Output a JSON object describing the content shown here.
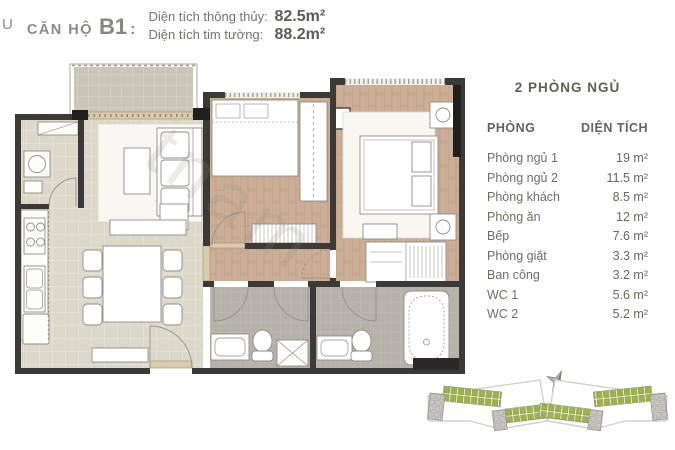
{
  "header": {
    "edge_text": "U",
    "unit_label": "CĂN HỘ",
    "unit_code": "B1",
    "separator": ":",
    "metrics": [
      {
        "label": "Diện tích thông thủy:",
        "value": "82.5m²"
      },
      {
        "label": "Diện tích tim tường:",
        "value": "88.2m²"
      }
    ]
  },
  "area_table": {
    "title": "2 PHÒNG NGỦ",
    "columns": {
      "room": "PHÒNG",
      "area": "DIỆN TÍCH"
    },
    "rows": [
      {
        "room": "Phòng ngủ 1",
        "area": "19 m²"
      },
      {
        "room": "Phòng ngủ 2",
        "area": "11.5 m²"
      },
      {
        "room": "Phòng khách",
        "area": "8.5 m²"
      },
      {
        "room": "Phòng ăn",
        "area": "12 m²"
      },
      {
        "room": "Bếp",
        "area": "7.6 m²"
      },
      {
        "room": "Phòng giặt",
        "area": "3.3 m²"
      },
      {
        "room": "Ban công",
        "area": "3.2 m²"
      },
      {
        "room": "WC 1",
        "area": "5.6 m²"
      },
      {
        "room": "WC 2",
        "area": "5.2 m²"
      }
    ]
  },
  "floorplan": {
    "watermark": "tnam"
  },
  "colors": {
    "wall": "#3b3a36",
    "wood_floor": "#c9ad94",
    "tile_floor": "#dcd9cb",
    "bath_tile": "#b5b2aa",
    "balcony_tile": "#c9c6b8",
    "siteplan_green": "#9fb248"
  }
}
